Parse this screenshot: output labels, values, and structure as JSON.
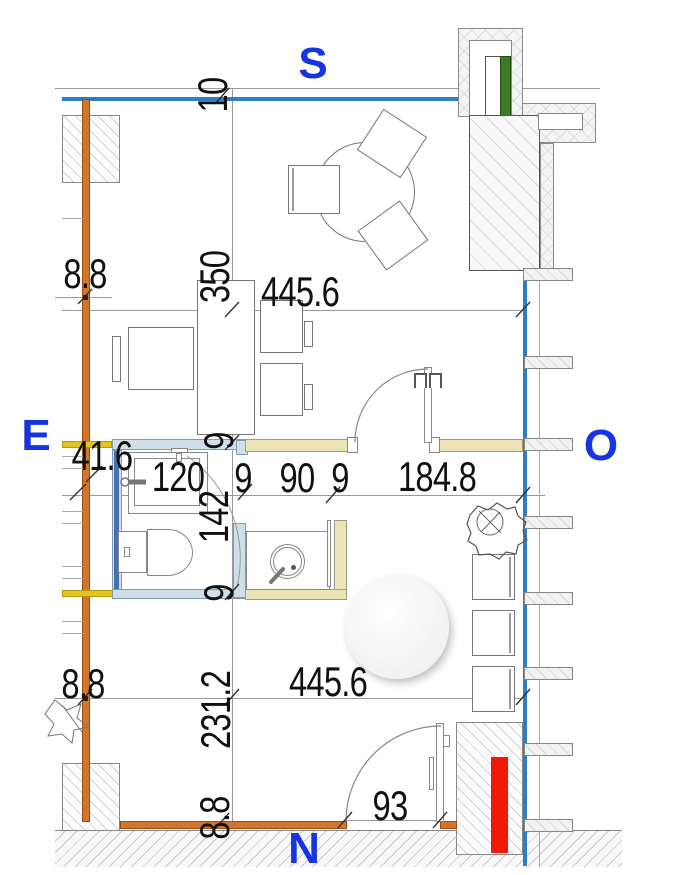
{
  "title": "apartment-floor-plan",
  "compass": {
    "south": "S",
    "east": "E",
    "west": "O",
    "north": "N"
  },
  "dims": {
    "top_gap": "10",
    "upper_left": "8.8",
    "upper_height": "350",
    "upper_width": "445.6",
    "entry": "41.6",
    "wall_top": "9",
    "bath_width": "120",
    "part1": "9",
    "opening": "90",
    "part2": "9",
    "living": "184.8",
    "bath_depth": "142",
    "wall_bottom": "9",
    "lower_left": "8.8",
    "lower_height": "231.2",
    "lower_width": "445.6",
    "door": "93",
    "base_wall": "8.8"
  },
  "colors": {
    "orange_wall": "#d3752b",
    "water_blue": "#2e7fc2",
    "navy_stripe": "#4a6fb2",
    "bright_yellow": "#e4c41f",
    "cream_wall": "#ebe4b6",
    "light_blue_wall": "#cfdfe8",
    "window_green": "#3c7a28",
    "marker_red": "#f21808",
    "compass_blue": "#1734e3"
  }
}
